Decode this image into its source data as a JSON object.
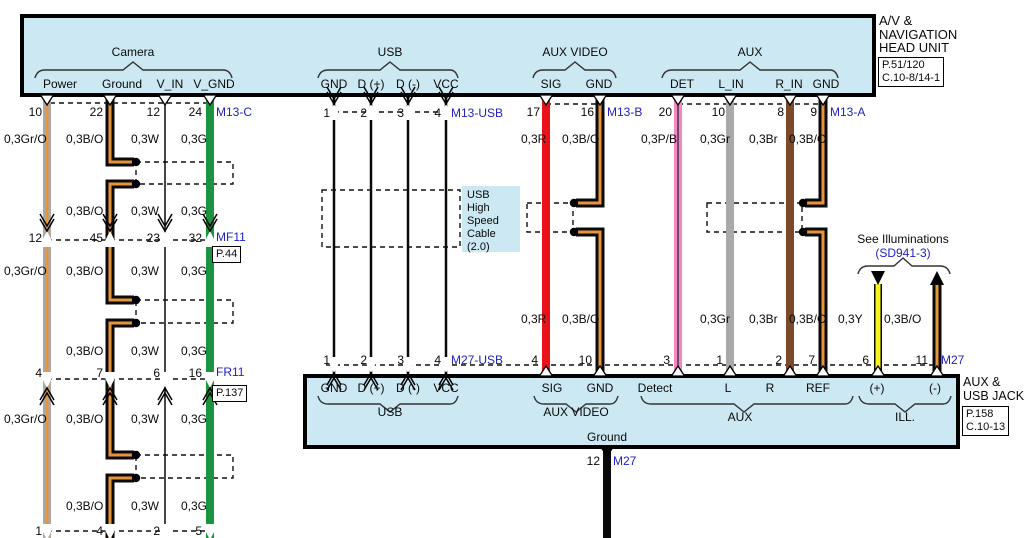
{
  "palette": {
    "box_fill": "#cbe8f3",
    "label_blue": "#2222c2",
    "wire_green": "#1a943f",
    "wire_red": "#e9121b",
    "wire_pink": "#f287c3",
    "wire_gray": "#a9a9a9",
    "wire_brown": "#7b4a2b",
    "wire_yellow": "#f8f41d",
    "wire_orange": "#e6953c",
    "wire_black": "#0a0a0a"
  },
  "head_unit": {
    "line1": "A/V &",
    "line2": "NAVIGATION",
    "line3": "HEAD UNIT",
    "ref1": "P.51/120",
    "ref2": "C.10-8/14-1"
  },
  "aux_usb_jack": {
    "line1": "AUX &",
    "line2": "USB JACK",
    "ref1": "P.158",
    "ref2": "C.10-13"
  },
  "usb_note": {
    "line1": "USB",
    "line2": "High",
    "line3": "Speed",
    "line4": "Cable",
    "line5": "(2.0)"
  },
  "wire_labels": {
    "grO": "0,3Gr/O",
    "bO": "0,3B/O",
    "w": "0,3W",
    "g": "0,3G",
    "r": "0,3R",
    "pB": "0,3P/B",
    "gr": "0,3Gr",
    "br": "0,3Br",
    "y": "0,3Y"
  },
  "top_sections": {
    "camera": {
      "title": "Camera",
      "pins": [
        "Power",
        "Ground",
        "V_IN",
        "V_GND"
      ],
      "pin_numbers": [
        "10",
        "22",
        "12",
        "24"
      ],
      "connector": "M13-C"
    },
    "usb": {
      "title": "USB",
      "pins": [
        "GND",
        "D (+)",
        "D (-)",
        "VCC"
      ],
      "pin_numbers": [
        "1",
        "2",
        "3",
        "4"
      ],
      "connector": "M13-USB"
    },
    "aux_video": {
      "title": "AUX VIDEO",
      "pins": [
        "SIG",
        "GND"
      ],
      "pin_numbers": [
        "17",
        "16"
      ],
      "connector": "M13-B"
    },
    "aux": {
      "title": "AUX",
      "pins": [
        "DET",
        "L_IN",
        "R_IN",
        "GND"
      ],
      "pin_numbers": [
        "20",
        "10",
        "8",
        "9"
      ],
      "connector": "M13-A"
    }
  },
  "mid_connectors": [
    {
      "connector": "MF11",
      "page": "P.44",
      "pin_numbers": [
        "12",
        "45",
        "23",
        "32"
      ]
    },
    {
      "connector": "FR11",
      "page": "P.137",
      "pin_numbers": [
        "4",
        "7",
        "6",
        "16"
      ]
    },
    {
      "connector": "",
      "page": "",
      "pin_numbers": [
        "1",
        "4",
        "2",
        "5"
      ]
    }
  ],
  "bottom_sections": {
    "usb": {
      "title": "USB",
      "pins": [
        "GND",
        "D (+)",
        "D (-)",
        "VCC"
      ],
      "pin_numbers": [
        "1",
        "2",
        "3",
        "4"
      ],
      "connector": "M27-USB"
    },
    "aux_video": {
      "title": "AUX VIDEO",
      "pins": [
        "SIG",
        "GND"
      ],
      "pin_numbers": [
        "4",
        "10"
      ]
    },
    "aux": {
      "title": "AUX",
      "pins": [
        "Detect",
        "L",
        "R",
        "REF"
      ],
      "pin_numbers": [
        "3",
        "1",
        "2",
        "7"
      ]
    },
    "ill": {
      "title": "ILL.",
      "pins": [
        "(+)",
        "(-)"
      ],
      "pin_numbers": [
        "6",
        "11"
      ],
      "connector": "M27"
    },
    "ground": {
      "label": "Ground",
      "pin_number": "12",
      "connector": "M27"
    }
  },
  "illumination": {
    "note_line1": "See Illuminations",
    "note_line2": "(SD941-3)"
  }
}
